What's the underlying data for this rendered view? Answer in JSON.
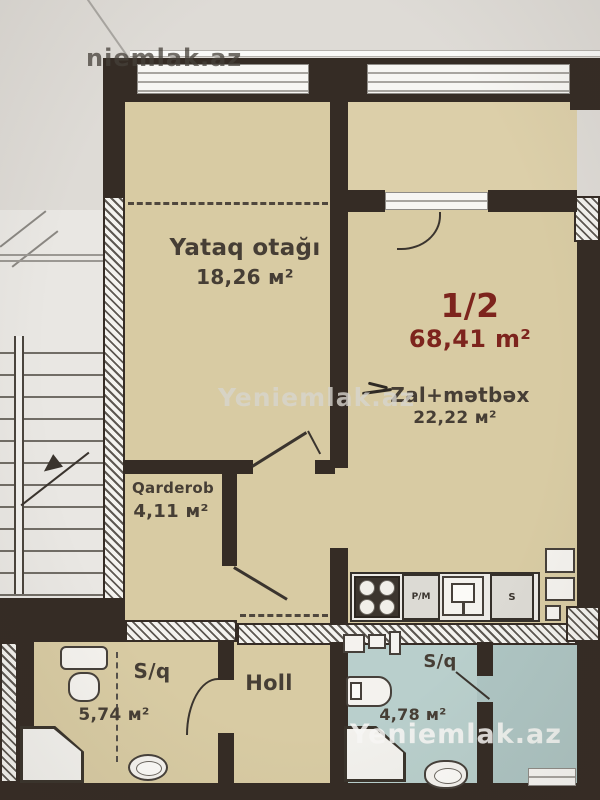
{
  "watermarks": {
    "top": "niemlak.az",
    "middle": "Yeniemlak.az",
    "bottom": "Yeniemlak.az"
  },
  "unit": {
    "number": "1/2",
    "total_area": "68,41 m²"
  },
  "rooms": {
    "bedroom": {
      "name": "Yataq otağı",
      "area": "18,26 м²"
    },
    "living_kitchen": {
      "name": "Zal+mətbəx",
      "area": "22,22 м²"
    },
    "wardrobe": {
      "name": "Qarderob",
      "area": "4,11 м²"
    },
    "hall": {
      "name": "Holl"
    },
    "bathroom_left": {
      "name": "S/q",
      "area": "5,74 м²"
    },
    "bathroom_right": {
      "name": "S/q",
      "area": "4,78 м²"
    }
  },
  "kitchen_appliances": {
    "dishwasher": "P/M",
    "fridge": "S"
  },
  "colors": {
    "background": "#dedbd6",
    "room_beige": "#d8cba3",
    "bathroom_blue": "#b9cfcc",
    "wall_dark": "#352c25",
    "unit_label_red": "#7d241d",
    "label_dark": "#463e35"
  }
}
